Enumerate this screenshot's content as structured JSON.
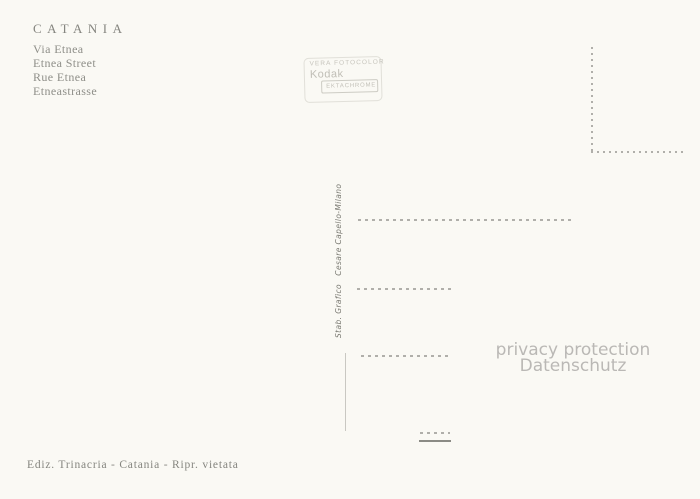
{
  "card": {
    "title": "CATANIA",
    "subtitle_lines": [
      "Via Etnea",
      "Etnea Street",
      "Rue Etnea",
      "Etneastrasse"
    ],
    "stamp": {
      "line_small": "VERA FOTOCOLOR",
      "brand": "Kodak",
      "film": "EKTACHROME"
    },
    "printer_credit": "Stab. Grafico   Cesare Capello-Milano",
    "watermark": {
      "line1": "privacy protection",
      "line2": "Datenschutz"
    },
    "publisher_line": "Ediz. Trinacria - Catania - Ripr. vietata",
    "colors": {
      "paper": "#faf9f4",
      "ink": "#85857f",
      "ink_light": "#8f8f89",
      "stamp_ink": "#c2c0b8",
      "line": "#b0afaa",
      "watermark": "#bab8b5"
    }
  }
}
